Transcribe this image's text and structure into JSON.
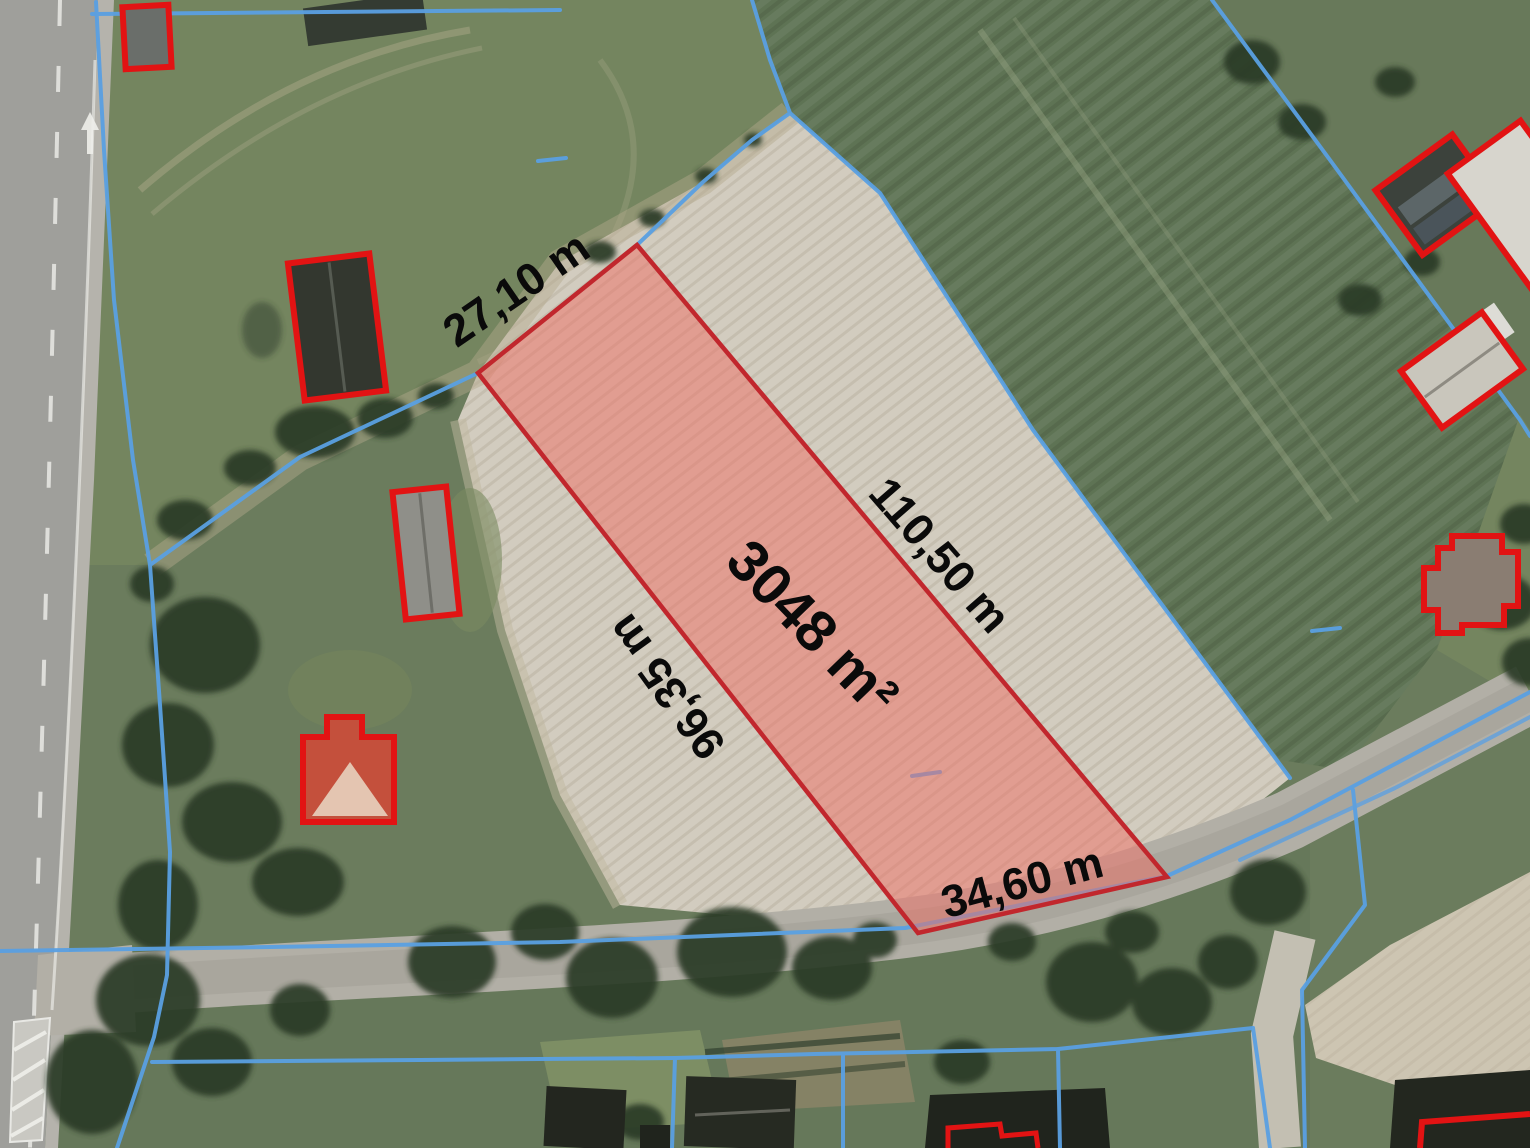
{
  "map": {
    "description": "Aerial cadastral preview of a highlighted land parcel for sale",
    "parcel": {
      "area_label": "3048 m²",
      "side_labels": {
        "top": "27,10 m",
        "right": "110,50 m",
        "bottom": "34,60 m",
        "left": "96,35 m"
      }
    },
    "colors": {
      "parcel_outline": "#c1272d",
      "parcel_fill": "rgba(240,110,100,0.5)",
      "cadastral_line": "#5aa0e2",
      "building_outline": "#e21313",
      "label_text": "#0a0a0a"
    }
  }
}
